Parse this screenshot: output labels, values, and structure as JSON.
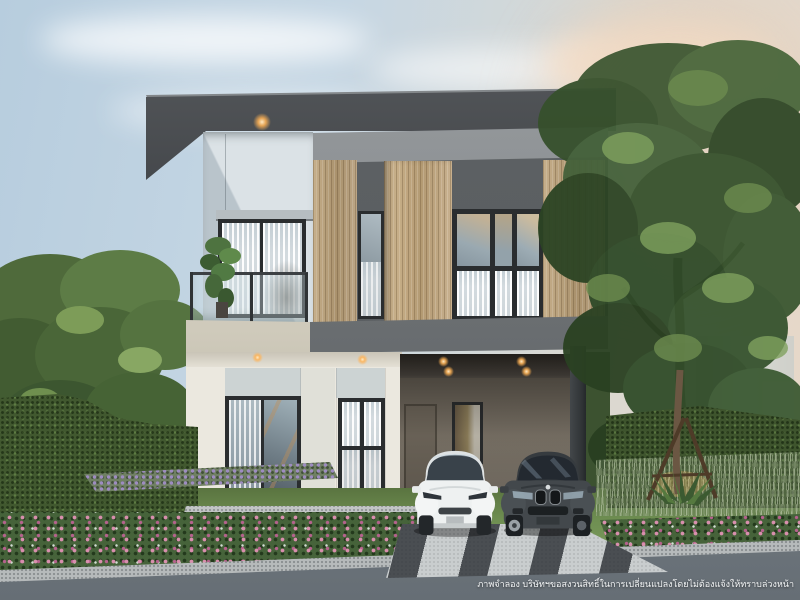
{
  "footer": {
    "disclaimer": "ภาพจำลอง บริษัทฯขอสงวนสิทธิ์ในการเปลี่ยนแปลงโดยไม่ต้องแจ้งให้ทราบล่วงหน้า"
  },
  "palette": {
    "sky_blue": "#b7cdde",
    "sky_warm": "#e9d8c7",
    "roof_dark": "#3f4246",
    "header_band_gray": "#8b8f92",
    "wall_second_floor": "#c3cdd3",
    "wood_slat": "#b9a27f",
    "dark_wall": "#5a5e61",
    "fascia_gray": "#6a6e71",
    "wall_cream": "#ebe8df",
    "carport_wall": "#7e776c",
    "column": "#35393b",
    "window_frame": "#2a2d2f",
    "hedge_green": "#41582f",
    "lawn_green": "#6a8a4e",
    "flower_pink": "#d98fae",
    "flower_purple": "#9d8cc0",
    "driveway_light": "#c9cdce",
    "driveway_dark": "#4a4e52",
    "road_gray": "#868e94",
    "car_white": "#eef1f1",
    "car_dark": "#43484c",
    "downlight_warm": "#ffb254"
  }
}
